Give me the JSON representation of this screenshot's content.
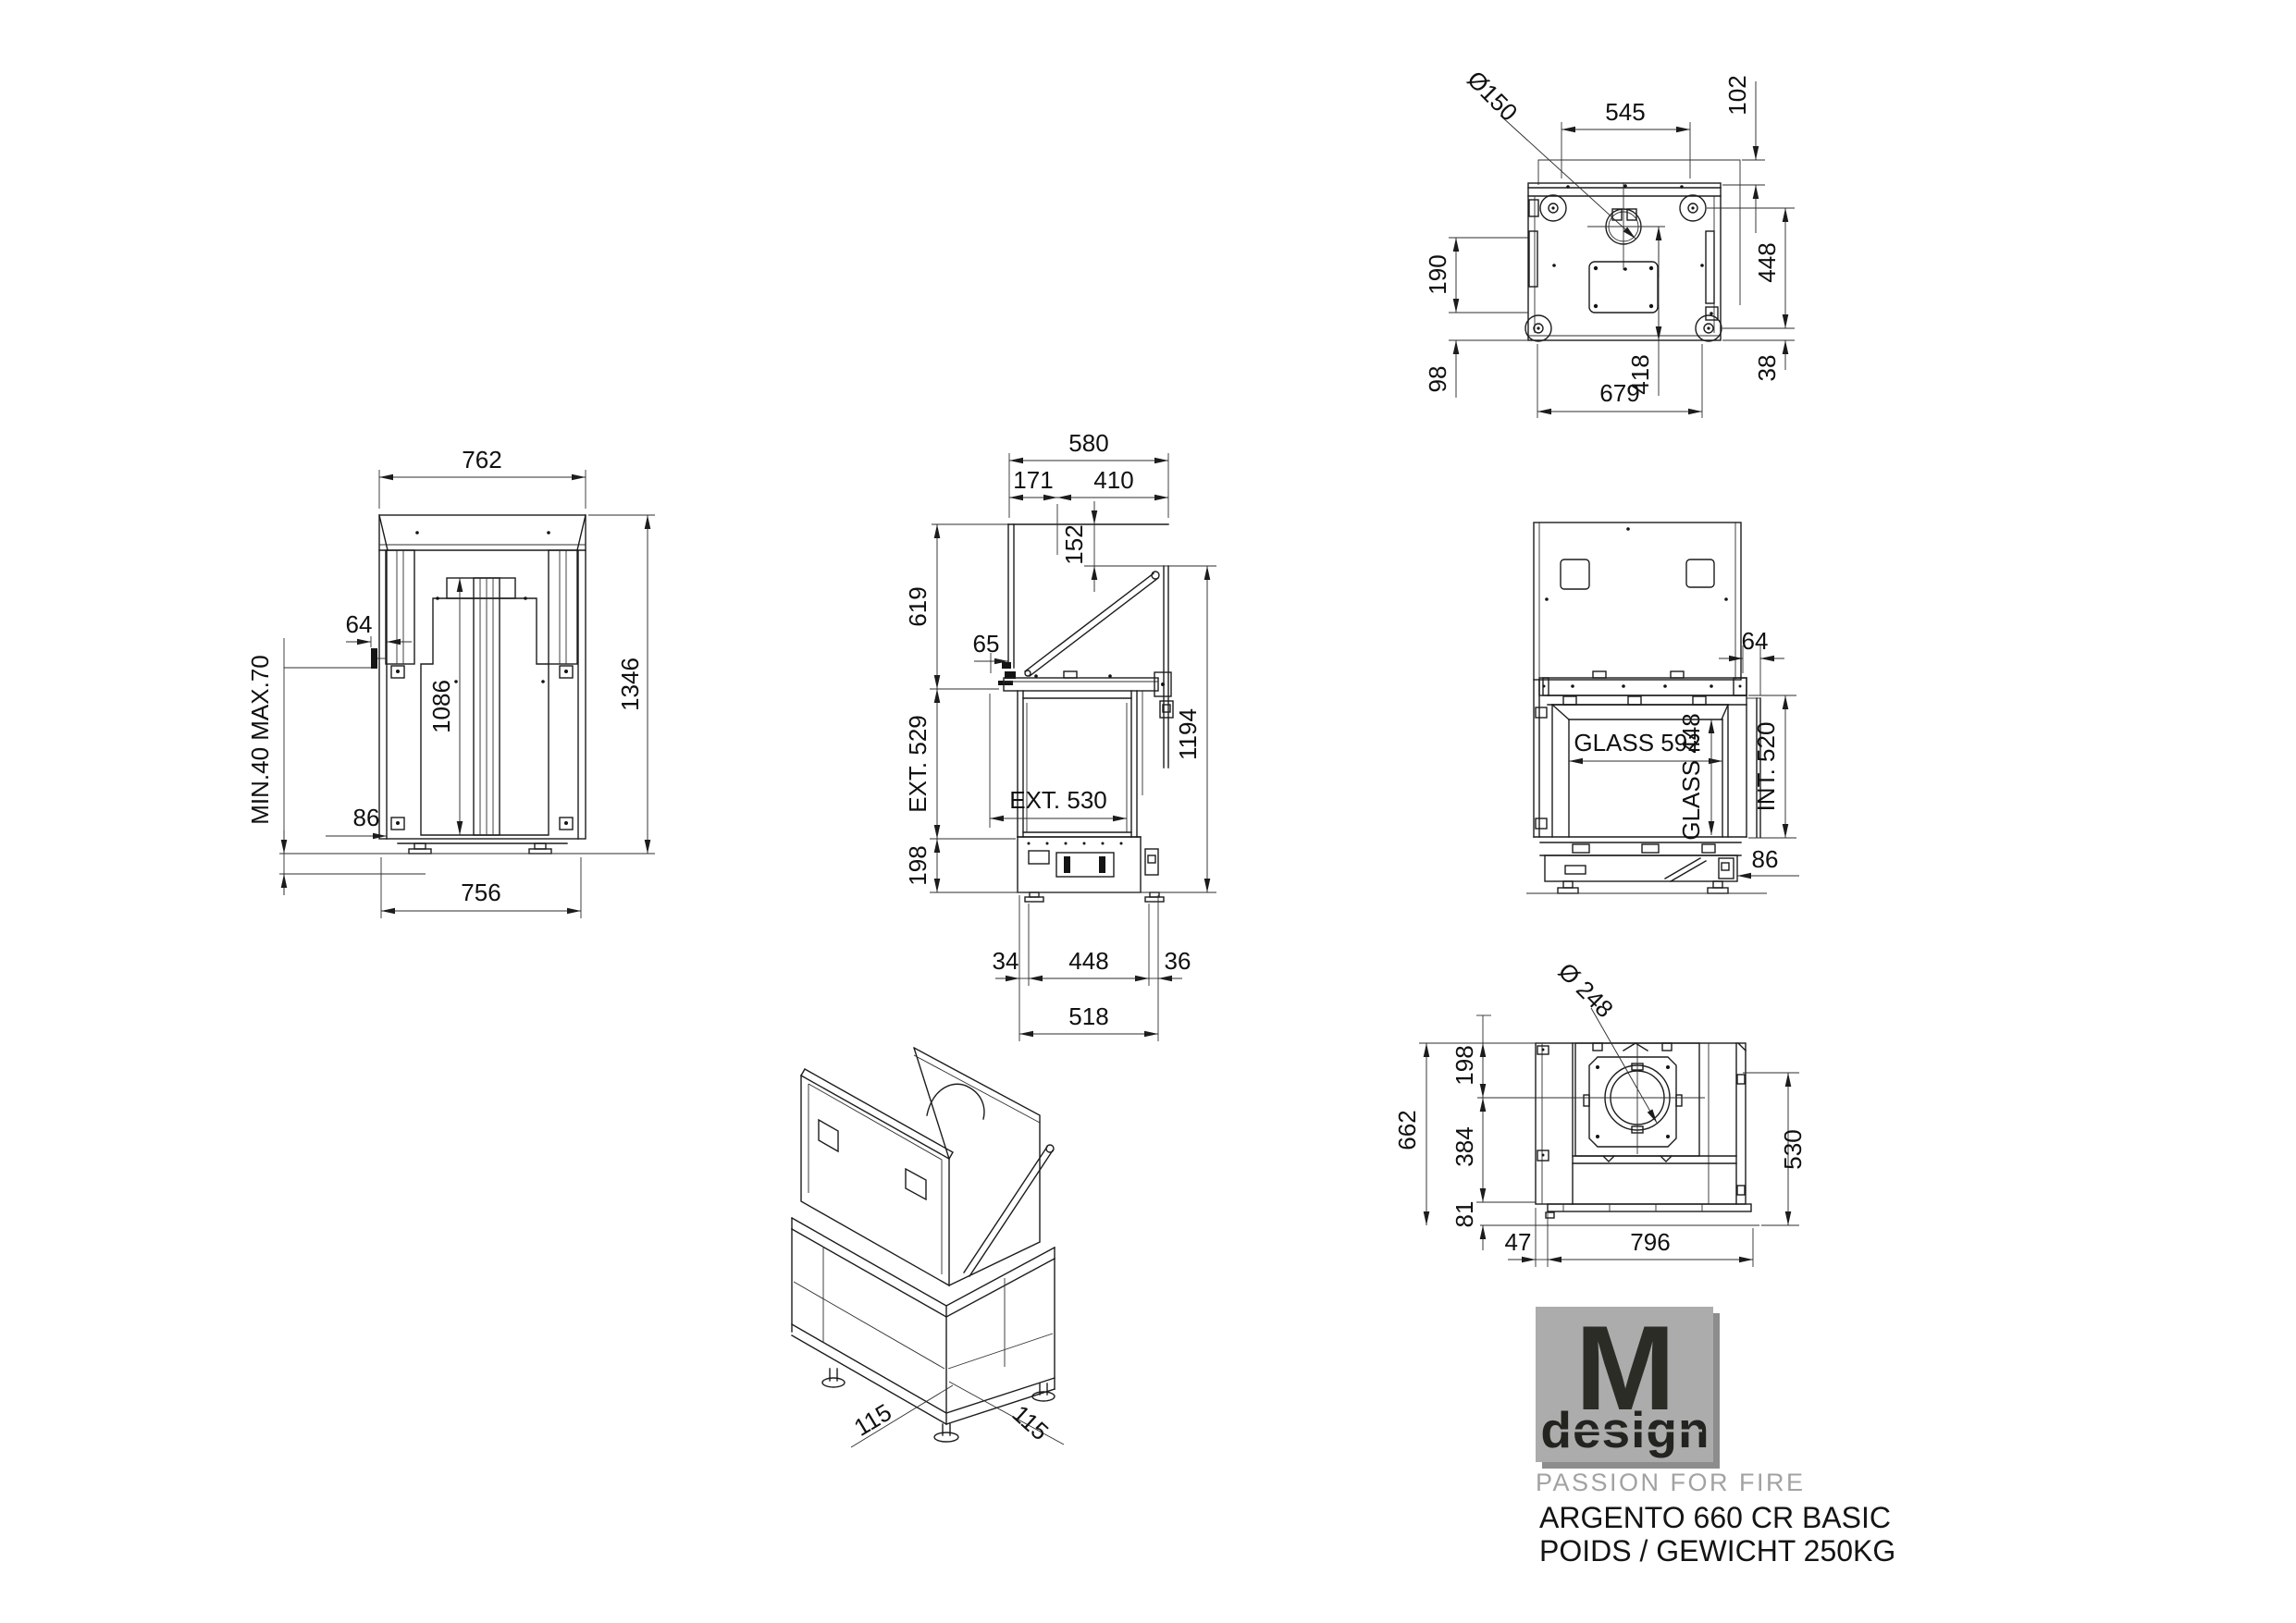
{
  "title_block": {
    "logo_letter": "M",
    "logo_word": "design",
    "tagline": "PASSION FOR FIRE",
    "product_line1": "ARGENTO 660 CR BASIC",
    "product_line2": "POIDS / GEWICHT 250KG"
  },
  "colors": {
    "line": "#1c1c1c",
    "logo_gray": "#acacac",
    "logo_shadow": "#8d8d8d",
    "logo_text": "#2c2c27",
    "tagline_gray": "#a2a2a2"
  },
  "views": {
    "rear": {
      "width_top": "762",
      "height": "1346",
      "width_bottom": "756",
      "center_height": "1086",
      "offset": "64",
      "feet_range": "MIN.40 MAX.70",
      "base": "86"
    },
    "side": {
      "depth": "580",
      "front": "171",
      "rear": "410",
      "drop": "152",
      "upper": "619",
      "gap": "65",
      "ext_h": "EXT. 529",
      "ext_d": "EXT. 530",
      "base": "198",
      "total": "1194",
      "foot_a": "34",
      "foot_b": "448",
      "foot_c": "36",
      "footprint": "518"
    },
    "front": {
      "offset": "64",
      "glass_w": "GLASS 592",
      "glass_h": "GLASS 448",
      "int_h": "INT. 520",
      "base": "86"
    },
    "top": {
      "flue": "Ø150",
      "w1": "545",
      "o1": "102",
      "l1": "190",
      "l2": "98",
      "depth": "418",
      "w2": "679",
      "r1": "448",
      "r2": "38"
    },
    "bottom": {
      "flue": "Ø 248",
      "h": "662",
      "o1": "198",
      "o2": "384",
      "o3": "81",
      "inset": "47",
      "w": "796",
      "rh": "530"
    },
    "iso": {
      "a": "115",
      "b": "115"
    }
  }
}
